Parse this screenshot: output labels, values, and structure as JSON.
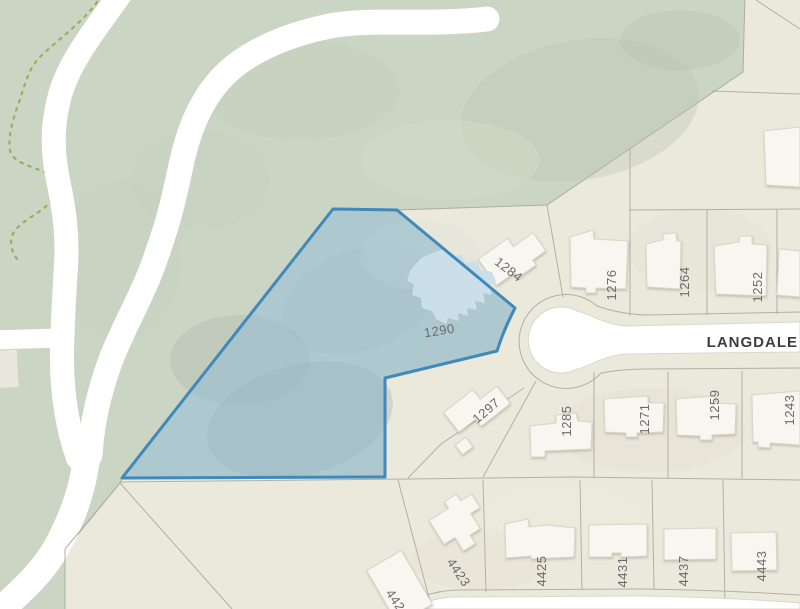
{
  "map": {
    "street_label": "LANGDALE",
    "selected_parcel": {
      "number": "1290"
    },
    "north_parcels": [
      {
        "number": "1284"
      },
      {
        "number": "1276"
      },
      {
        "number": "1264"
      },
      {
        "number": "1252"
      }
    ],
    "mid_parcels": [
      {
        "number": "1297"
      },
      {
        "number": "1285"
      },
      {
        "number": "1271"
      },
      {
        "number": "1259"
      },
      {
        "number": "1243"
      }
    ],
    "south_parcels": [
      {
        "number": "4423"
      },
      {
        "number": "4425"
      },
      {
        "number": "4431"
      },
      {
        "number": "4437"
      },
      {
        "number": "4443"
      },
      {
        "number": "4421"
      }
    ],
    "colors": {
      "selection_fill": "#8fbcd9",
      "selection_border": "#4189ba",
      "forest_green": "#cbd5c3",
      "parcel_beige": "#ebe8dc",
      "road_white": "#ffffff",
      "boundary_gray": "#b2b0a5",
      "label_gray": "#6b6b6b",
      "street_label_color": "#3e3e3e",
      "trail_green": "#9cad5f"
    }
  }
}
